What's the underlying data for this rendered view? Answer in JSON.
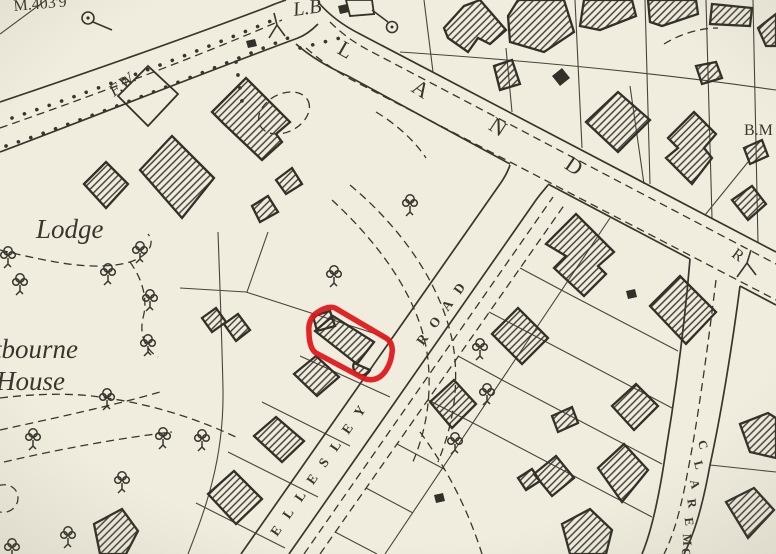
{
  "map": {
    "colors": {
      "paper": "#f1edde",
      "ink": "#38352d",
      "highlight": "#e0191c"
    },
    "labels": {
      "benchmark_value": "M.403'9",
      "letter_box": "L.B",
      "footway": "F.W.",
      "lodge": "Lodge",
      "house_name_line1": "tbourne",
      "house_name_line2": "House",
      "benchmark_right": "B.M",
      "land_road_letters": [
        "L",
        "A",
        "N",
        "D"
      ],
      "land_road_initial_r": "R",
      "wellesley_name": "ELLESLEY",
      "wellesley_road_word": "ROAD",
      "claremont_letters": [
        "C",
        "L",
        "A",
        "R",
        "E",
        "M",
        "O"
      ]
    }
  }
}
